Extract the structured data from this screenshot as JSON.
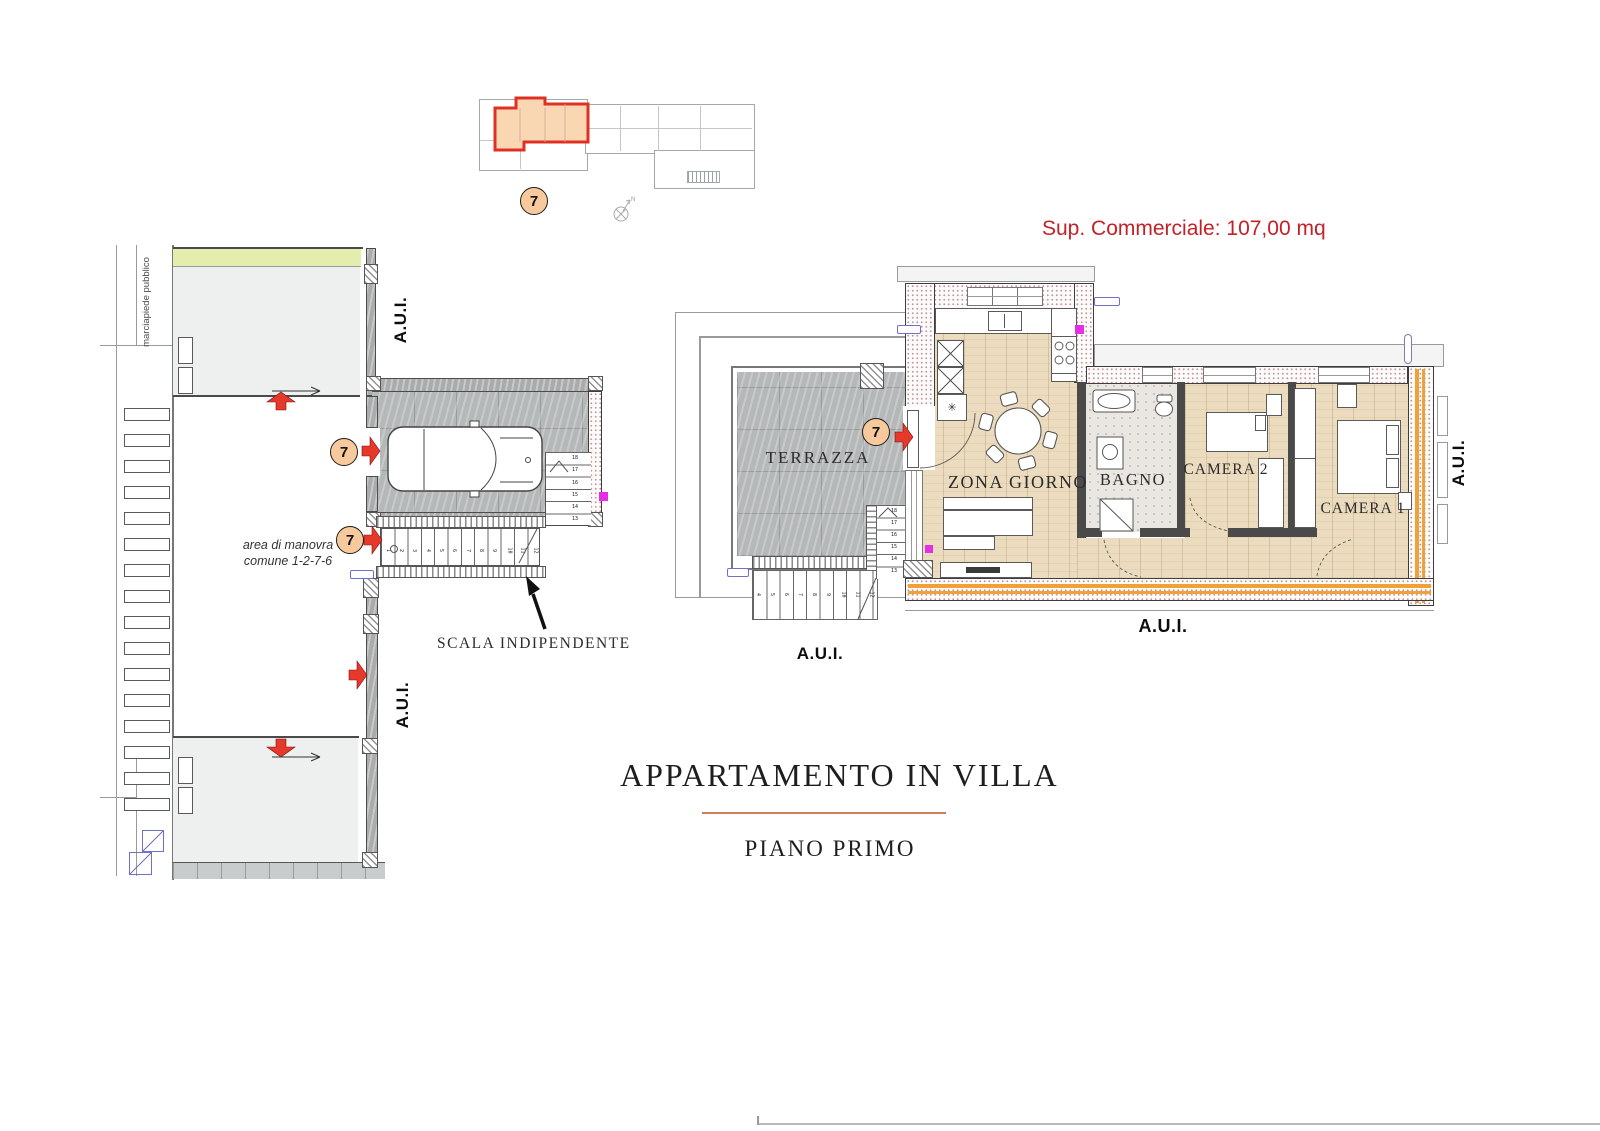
{
  "palette": {
    "accent_red": "#c42127",
    "arrow_red": "#e5392b",
    "marker_fill": "#f7c99d",
    "wood": "#ecdcbf",
    "tile_gray": "#b5b8b9",
    "wall_dot": "#cc9595",
    "orange": "#f0a137",
    "green": "#e4ecae"
  },
  "header": {
    "area_label": "Sup. Commerciale: 107,00 mq"
  },
  "overview": {
    "unit_marker": "7",
    "compass_north": "N"
  },
  "site": {
    "sidewalk_label": "marciapiede pubblico",
    "aui_label": "A.U.I.",
    "maneuver_line1": "area di manovra",
    "maneuver_line2": "comune 1-2-7-6",
    "garage_label": "BOX",
    "stairs_label": "SCALA INDIPENDENTE",
    "unit_marker": "7",
    "garage_stair_numbers": [
      "18",
      "17",
      "16",
      "15",
      "14",
      "13"
    ],
    "lower_stair_numbers": [
      "1",
      "2",
      "3",
      "4",
      "5",
      "6",
      "7",
      "8",
      "9",
      "10",
      "11",
      "12"
    ]
  },
  "apartment": {
    "aui_label": "A.U.I.",
    "unit_marker": "7",
    "fridge_symbol": "✳",
    "rooms": {
      "terrazza": "TERRAZZA",
      "zona_giorno": "ZONA GIORNO",
      "bagno": "BAGNO",
      "camera2": "CAMERA 2",
      "camera1": "CAMERA 1"
    },
    "terrace_stair_numbers_upper": [
      "18",
      "17",
      "16",
      "15",
      "14",
      "13"
    ],
    "terrace_stair_numbers_lower": [
      "4",
      "5",
      "6",
      "7",
      "8",
      "9",
      "10",
      "11",
      "12"
    ]
  },
  "title_block": {
    "title": "APPARTAMENTO IN VILLA",
    "subtitle": "PIANO PRIMO"
  }
}
